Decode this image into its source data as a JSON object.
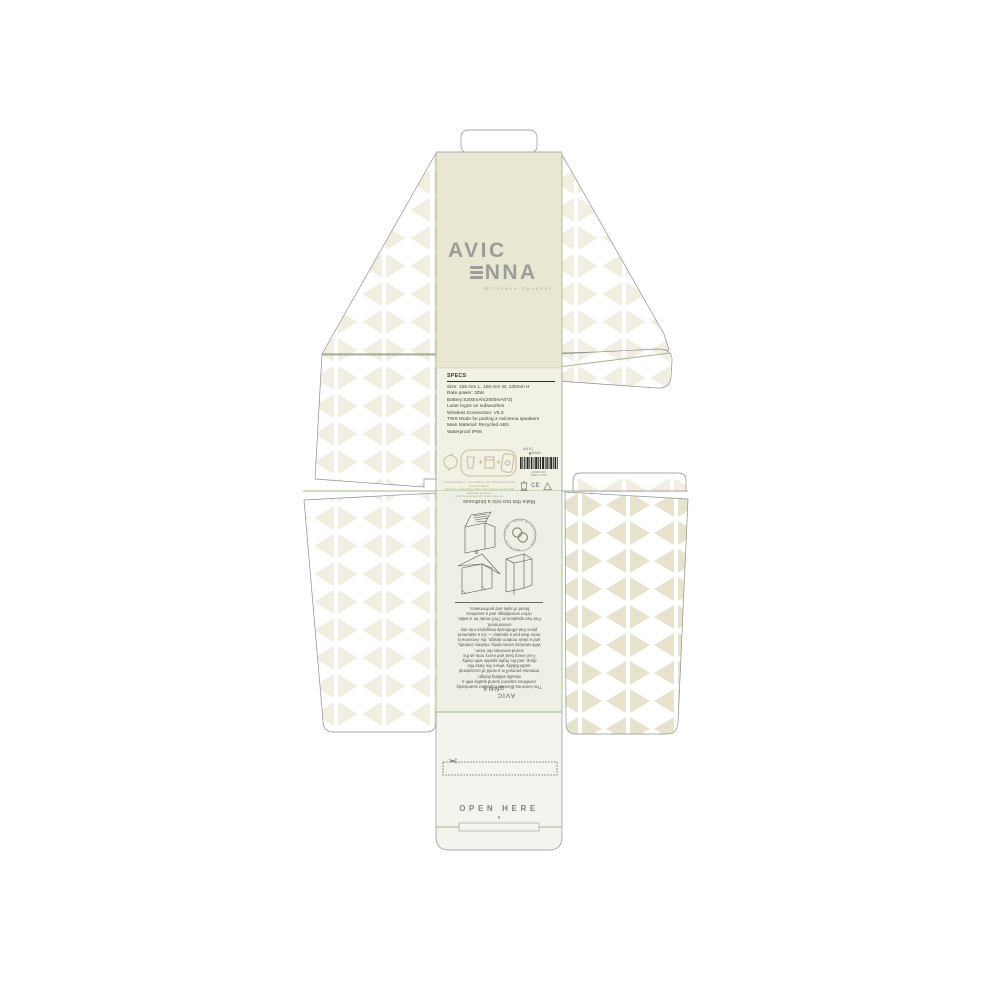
{
  "brand": {
    "name_line1": "AVIC",
    "name_line2_rest": "NNA",
    "tagline": "Wireless Speaker"
  },
  "specs": {
    "heading": "SPECS",
    "lines": [
      "Size: 105 mm L, 105 mm W, 130mm H",
      "Rate power: 30W",
      "Battery:5200mAh(2600mAh*2)",
      "Laser logos on subwoofers",
      "Wireless Connection: V5.3",
      "TWS Mode for pairing 2 Avicenna speakers",
      "Main Material: Recycled ABS",
      "Waterproof IP66"
    ]
  },
  "regulatory": {
    "fine_print_lines": [
      "Avicenna Audio Co., Ltd. Building 2, No. 88 Innovation Road, Nanshan District,",
      "Shenzhen, Guangdong, China. This product complies with applicable directives.",
      "Keep this packaging for future reference."
    ],
    "mini_logo_line1": "AVIC",
    "mini_logo_line2": "NNA",
    "barcode_caption_line1": "AVSPK-001",
    "barcode_caption_line2": "Made in PRC",
    "ce_mark": "CE"
  },
  "reuse_panel": {
    "title": "Make this box into a birdhouse",
    "badge_rim_text": "RECYCLE · REUSE · MADE WITH PURPOSE ·",
    "paragraph_lines": [
      "The Avicenna Bluetooth Speaker seamlessly",
      "combines superior sound quality with a",
      "visually striking design.",
      "Immerse yourself in a world of exceptional",
      "audio fidelity, where the bass hits",
      "deep, and the highs sparkle with clarity.",
      "Feel every beat and every note as the",
      "sound envelops the room.",
      "With wireless connectivity, intuitive controls,",
      "and a sleek modern design, the Avicenna is",
      "more than just a speaker — it's a statement",
      "piece that effortlessly integrates into any",
      "environment.",
      "Pair two speakers in TWS mode for a wider,",
      "richer soundstage and a seamless",
      "blend of style and performance."
    ],
    "logo_line1": "AVIC",
    "logo_line2": "NNA"
  },
  "open_strip": {
    "label": "OPEN HERE",
    "arrow": "▾",
    "scissors_icon": "✂"
  },
  "colors": {
    "cream": "#e9e6d2",
    "specs_tint": "#f2f1e6",
    "instructions_tint": "#edf0e4",
    "strip_tint": "#f3f4ee",
    "fold_green": "#9fba8e",
    "cut_gray": "#8f8f8f",
    "pattern_strong": "#e8e3cc",
    "pattern_faint": "#f2efe2",
    "logo_gray": "#9c9c98",
    "icon_tan": "#c9bd9b"
  }
}
